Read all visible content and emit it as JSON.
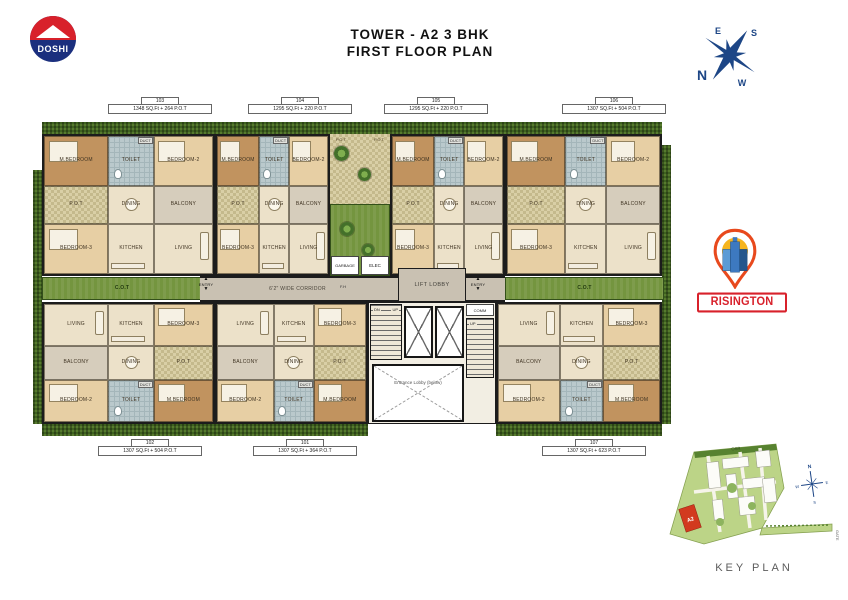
{
  "header": {
    "logo_text": "DOSHI",
    "title_line1": "TOWER - A2  3 BHK",
    "title_line2": "FIRST FLOOR PLAN"
  },
  "compass": {
    "n": "N",
    "e": "E",
    "s": "S",
    "w": "W"
  },
  "brand": {
    "wordmark": "RISINGTON"
  },
  "plan": {
    "corridor_label": "6'2\" WIDE CORRIDOR",
    "lift_lobby_label": "LIFT LOBBY",
    "entrance_lobby_label": "Entrance Lobby (below)",
    "entry_label": "ENTRY",
    "up_label": "UP",
    "dn_label": "DN",
    "cot_label": "C.O.T",
    "pot_label": "P.O.T",
    "duct_label": "DUCT",
    "elec_label": "ELEC",
    "garbage_label": "GARBAGE",
    "comm_label": "COMM",
    "fire_hose_label": "F.H",
    "units": [
      {
        "id": "103",
        "area": "1348 SQ.Ft + 264 P.O.T",
        "row": "top",
        "x": 42,
        "w": 173,
        "label_cx": 160
      },
      {
        "id": "104",
        "area": "1295 SQ.Ft + 220 P.O.T",
        "row": "top",
        "x": 215,
        "w": 115,
        "label_cx": 300
      },
      {
        "id": "105",
        "area": "1295 SQ.Ft + 220 P.O.T",
        "row": "top",
        "x": 390,
        "w": 115,
        "label_cx": 436
      },
      {
        "id": "106",
        "area": "1307 SQ.Ft + 504 P.O.T",
        "row": "top",
        "x": 505,
        "w": 157,
        "label_cx": 614
      },
      {
        "id": "102",
        "area": "1307 SQ.Ft + 504 P.O.T",
        "row": "bottom",
        "x": 42,
        "w": 173,
        "label_cx": 150
      },
      {
        "id": "101",
        "area": "1307 SQ.Ft + 364 P.O.T",
        "row": "bottom",
        "x": 215,
        "w": 153,
        "label_cx": 305
      },
      {
        "id": "107",
        "area": "1307 SQ.Ft + 623 P.O.T",
        "row": "bottom",
        "x": 496,
        "w": 166,
        "label_cx": 594
      }
    ],
    "rooms_top": [
      {
        "name": "M.BEDROOM",
        "type": "master"
      },
      {
        "name": "TOILET",
        "type": "toilet"
      },
      {
        "name": "BEDROOM-2",
        "type": "bedroom"
      },
      {
        "name": "P.O.T",
        "type": "pot"
      },
      {
        "name": "DINING",
        "type": "dining"
      },
      {
        "name": "BALCONY",
        "type": "balcony"
      },
      {
        "name": "BEDROOM-3",
        "type": "bedroom"
      },
      {
        "name": "KITCHEN",
        "type": "kitchen"
      },
      {
        "name": "LIVING",
        "type": "living"
      }
    ],
    "rooms_bottom": [
      {
        "name": "LIVING",
        "type": "living"
      },
      {
        "name": "KITCHEN",
        "type": "kitchen"
      },
      {
        "name": "BEDROOM-3",
        "type": "bedroom"
      },
      {
        "name": "BALCONY",
        "type": "balcony"
      },
      {
        "name": "DINING",
        "type": "dining"
      },
      {
        "name": "P.O.T",
        "type": "pot"
      },
      {
        "name": "BEDROOM-2",
        "type": "bedroom"
      },
      {
        "name": "TOILET",
        "type": "toilet"
      },
      {
        "name": "M.BEDROOM",
        "type": "master"
      }
    ]
  },
  "key_plan": {
    "label": "KEY PLAN",
    "tower_label": "A2",
    "osr_label": "OSR",
    "gate_label": "GATE"
  },
  "colors": {
    "accent_red": "#d8212b",
    "logo_blue": "#1b2f7e",
    "compass_blue": "#1d4686",
    "hedge_green": "#3f6220",
    "lawn_green": "#74953f",
    "floor_beige": "#ece1c9",
    "wood_brown": "#c1935f",
    "wall_dark": "#1c1c1c"
  }
}
